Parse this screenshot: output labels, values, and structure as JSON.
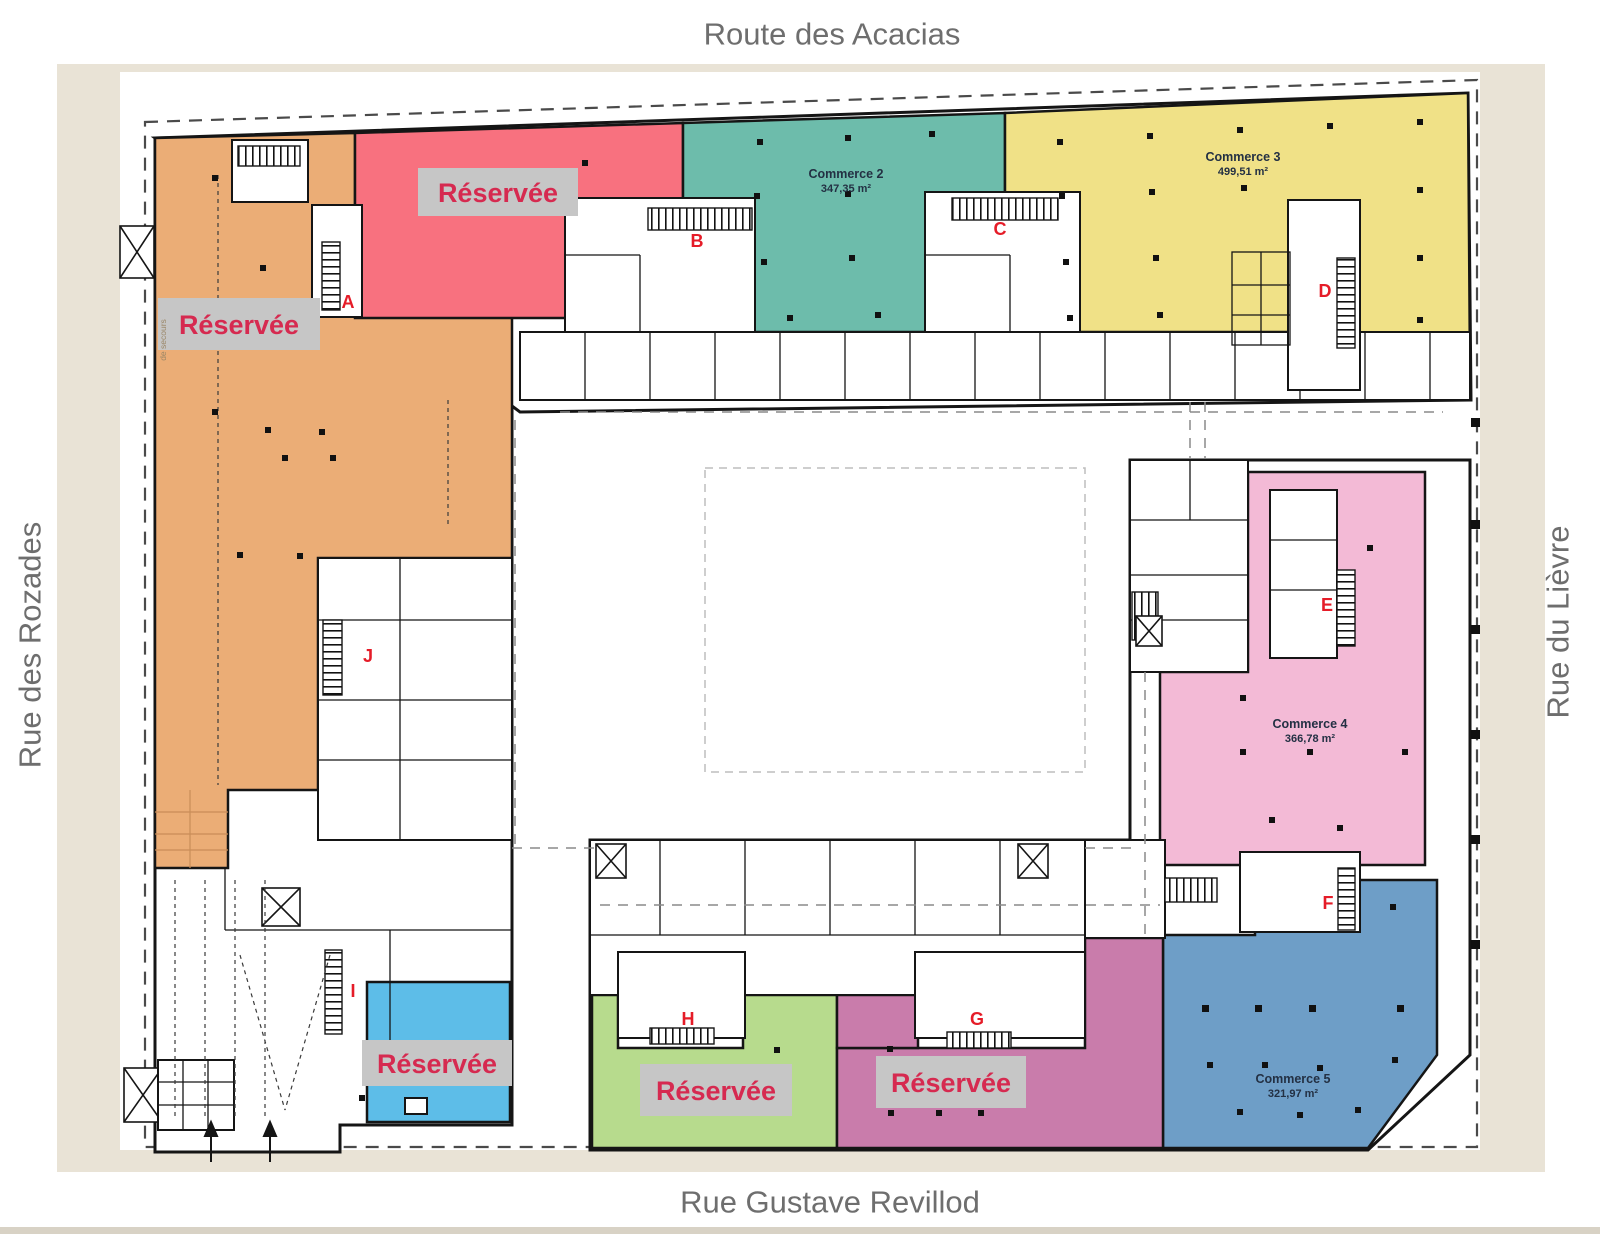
{
  "streets": {
    "top": "Route des Acacias",
    "left": "Rue des Rozades",
    "right": "Rue du Lièvre",
    "bottom": "Rue Gustave Revillod"
  },
  "reserved_label": "Réservée",
  "side_note": "de secours",
  "commerces": [
    {
      "name": "Commerce 2",
      "area": "347,35 m²",
      "color": "#6dbcab"
    },
    {
      "name": "Commerce 3",
      "area": "499,51 m²",
      "color": "#f0e187"
    },
    {
      "name": "Commerce 4",
      "area": "366,78 m²",
      "color": "#f3bad6"
    },
    {
      "name": "Commerce 5",
      "area": "321,97 m²",
      "color": "#6e9ec7"
    }
  ],
  "reserved_zones": [
    {
      "id": "west",
      "color": "#ebad76"
    },
    {
      "id": "north",
      "color": "#f8717f"
    },
    {
      "id": "southwest",
      "color": "#5dbde8"
    },
    {
      "id": "south-green",
      "color": "#b7db8d"
    },
    {
      "id": "south-magenta",
      "color": "#c97cab"
    }
  ],
  "markers": [
    {
      "label": "A"
    },
    {
      "label": "B"
    },
    {
      "label": "C"
    },
    {
      "label": "D"
    },
    {
      "label": "E"
    },
    {
      "label": "F"
    },
    {
      "label": "G"
    },
    {
      "label": "H"
    },
    {
      "label": "I"
    },
    {
      "label": "J"
    }
  ],
  "colors": {
    "frame": "#e9e3d6",
    "bottom_strip": "#d8d2c5",
    "marker_text": "#e51c28",
    "reserved_text": "#d62a50",
    "label_box": "#c6c6c6",
    "street_text": "#6e6e6e",
    "commerce_text": "#233043"
  }
}
